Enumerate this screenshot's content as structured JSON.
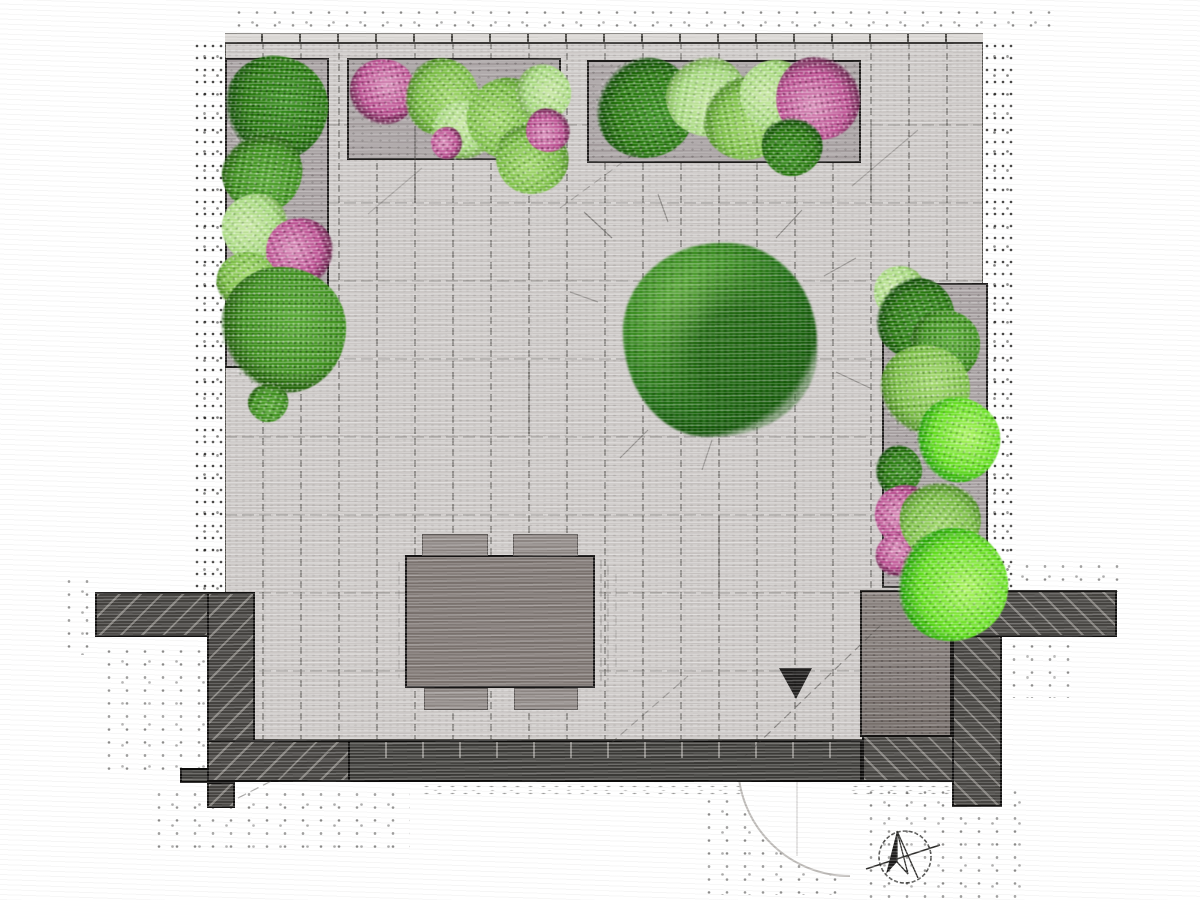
{
  "meta": {
    "type": "garden-landscape-plan",
    "canvas_w": 1200,
    "canvas_h": 900,
    "background": "#ffffff",
    "description": "Top-down sketch-style garden design plan: paved patio with tile grid, perimeter planting beds, central tree canopy, dining table with four chairs, hatched boundary walls, gate swing arc and north arrow"
  },
  "palette": {
    "paving": "#cbc7c5",
    "paving_joint": "#45433f",
    "bed_fill": "#a49d9e",
    "bed_border": "#1d1b1a",
    "wall_dark": "#44423f",
    "wall_solid": "#3b3a37",
    "wall_hatch_line": "#dedad4",
    "block_fill": "#7b7370",
    "table_fill": "#7a726e",
    "chair_fill": "#8c8582",
    "plant_dark_green": "#2a7612",
    "plant_medium_green": "#3f8d20",
    "plant_light_green": "#7cbc49",
    "plant_pale_green": "#a8d982",
    "plant_bright_green": "#67dd26",
    "flower_pink": "#b7508f",
    "outline": "#100f0e",
    "arc_line": "#b5b1ae",
    "symbol_ink": "#2c2b29"
  },
  "paving": {
    "x": 225,
    "y": 42,
    "w": 758,
    "h": 698,
    "tile_w": 38,
    "tile_h": 78,
    "first_row_h": 83
  },
  "edge_band": {
    "x": 225,
    "y": 33,
    "w": 758,
    "h": 11
  },
  "beds": [
    {
      "id": "planting-bed-left",
      "x": 225,
      "y": 58,
      "w": 104,
      "h": 310
    },
    {
      "id": "planting-bed-top-west",
      "x": 347,
      "y": 58,
      "w": 214,
      "h": 102
    },
    {
      "id": "planting-bed-top-east",
      "x": 587,
      "y": 60,
      "w": 274,
      "h": 103
    },
    {
      "id": "planting-bed-right",
      "x": 882,
      "y": 283,
      "w": 106,
      "h": 305
    }
  ],
  "tree": {
    "cx": 720,
    "cy": 340,
    "r": 97
  },
  "plants": [
    {
      "cx": 276,
      "cy": 108,
      "r": 52,
      "type": "dark"
    },
    {
      "cx": 262,
      "cy": 172,
      "r": 40,
      "type": "medium"
    },
    {
      "cx": 256,
      "cy": 228,
      "r": 34,
      "type": "pale"
    },
    {
      "cx": 300,
      "cy": 252,
      "r": 34,
      "type": "pink"
    },
    {
      "cx": 247,
      "cy": 282,
      "r": 30,
      "type": "light"
    },
    {
      "cx": 283,
      "cy": 330,
      "r": 63,
      "type": "medium"
    },
    {
      "cx": 268,
      "cy": 402,
      "r": 20,
      "type": "medium"
    },
    {
      "cx": 383,
      "cy": 92,
      "r": 33,
      "type": "pink"
    },
    {
      "cx": 441,
      "cy": 97,
      "r": 38,
      "type": "light"
    },
    {
      "cx": 463,
      "cy": 131,
      "r": 30,
      "type": "pale"
    },
    {
      "cx": 507,
      "cy": 118,
      "r": 40,
      "type": "light"
    },
    {
      "cx": 532,
      "cy": 158,
      "r": 36,
      "type": "light"
    },
    {
      "cx": 447,
      "cy": 143,
      "r": 16,
      "type": "pink"
    },
    {
      "cx": 543,
      "cy": 93,
      "r": 28,
      "type": "pale"
    },
    {
      "cx": 548,
      "cy": 130,
      "r": 22,
      "type": "pink"
    },
    {
      "cx": 645,
      "cy": 108,
      "r": 50,
      "type": "dark"
    },
    {
      "cx": 706,
      "cy": 96,
      "r": 40,
      "type": "pale"
    },
    {
      "cx": 745,
      "cy": 118,
      "r": 42,
      "type": "light"
    },
    {
      "cx": 775,
      "cy": 95,
      "r": 35,
      "type": "pale"
    },
    {
      "cx": 818,
      "cy": 98,
      "r": 42,
      "type": "pink"
    },
    {
      "cx": 792,
      "cy": 146,
      "r": 30,
      "type": "dark"
    },
    {
      "cx": 900,
      "cy": 292,
      "r": 26,
      "type": "pale"
    },
    {
      "cx": 915,
      "cy": 318,
      "r": 40,
      "type": "dark"
    },
    {
      "cx": 945,
      "cy": 345,
      "r": 35,
      "type": "medium"
    },
    {
      "cx": 925,
      "cy": 390,
      "r": 45,
      "type": "light"
    },
    {
      "cx": 958,
      "cy": 440,
      "r": 42,
      "type": "bright"
    },
    {
      "cx": 898,
      "cy": 470,
      "r": 24,
      "type": "dark"
    },
    {
      "cx": 905,
      "cy": 515,
      "r": 30,
      "type": "pink"
    },
    {
      "cx": 898,
      "cy": 555,
      "r": 22,
      "type": "pink"
    },
    {
      "cx": 940,
      "cy": 520,
      "r": 40,
      "type": "light"
    },
    {
      "cx": 952,
      "cy": 585,
      "r": 56,
      "type": "bright"
    }
  ],
  "walls": [
    {
      "id": "wall-west-arm",
      "x": 95,
      "y": 592,
      "w": 160,
      "h": 45,
      "style": "hatch-l"
    },
    {
      "id": "wall-west-vertical",
      "x": 207,
      "y": 592,
      "w": 48,
      "h": 190,
      "style": "hatch-l"
    },
    {
      "id": "wall-west-foot",
      "x": 180,
      "y": 768,
      "w": 30,
      "h": 15,
      "style": "solid"
    },
    {
      "id": "wall-west-stub",
      "x": 207,
      "y": 782,
      "w": 28,
      "h": 26,
      "style": "hatch-l"
    },
    {
      "id": "wall-south-west",
      "x": 207,
      "y": 740,
      "w": 143,
      "h": 42,
      "style": "hatch-l"
    },
    {
      "id": "wall-south",
      "x": 348,
      "y": 740,
      "w": 514,
      "h": 42,
      "style": "solid",
      "ticks": true
    },
    {
      "id": "wall-south-east",
      "x": 862,
      "y": 735,
      "w": 113,
      "h": 47,
      "style": "hatch-r"
    },
    {
      "id": "wall-east-vertical",
      "x": 952,
      "y": 588,
      "w": 50,
      "h": 219,
      "style": "hatch-r"
    },
    {
      "id": "wall-east-arm",
      "x": 952,
      "y": 590,
      "w": 165,
      "h": 47,
      "style": "hatch-r"
    }
  ],
  "block": {
    "id": "storage-block",
    "x": 860,
    "y": 590,
    "w": 92,
    "h": 147
  },
  "furniture": {
    "table": {
      "x": 405,
      "y": 555,
      "w": 190,
      "h": 133
    },
    "chairs": [
      {
        "x": 422,
        "y": 534,
        "w": 66,
        "h": 22
      },
      {
        "x": 513,
        "y": 534,
        "w": 65,
        "h": 22
      },
      {
        "x": 424,
        "y": 688,
        "w": 64,
        "h": 22
      },
      {
        "x": 514,
        "y": 688,
        "w": 64,
        "h": 22
      }
    ]
  },
  "door": {
    "hinge_x": 850,
    "hinge_y": 764,
    "radius": 112,
    "leaf": [
      797,
      780,
      797,
      856
    ]
  },
  "compass": {
    "cx": 905,
    "cy": 857,
    "r": 26,
    "cross_line": [
      866,
      869,
      940,
      845
    ],
    "tail_line": [
      897,
      831,
      918,
      878
    ],
    "needle_fill": "897,831 886,874 897,862",
    "needle_open": "897,831 908,874 897,862"
  },
  "triangle_marker": {
    "points": "779,668 812,668 796,699"
  },
  "sketch_lines": [
    [
      612,
      238,
      584,
      212,
      0.5
    ],
    [
      668,
      222,
      658,
      194,
      0.45
    ],
    [
      776,
      238,
      802,
      210,
      0.45
    ],
    [
      824,
      276,
      856,
      258,
      0.4
    ],
    [
      836,
      372,
      870,
      388,
      0.4
    ],
    [
      648,
      430,
      620,
      458,
      0.4
    ],
    [
      712,
      440,
      702,
      470,
      0.35
    ],
    [
      598,
      302,
      570,
      292,
      0.35
    ],
    [
      744,
      757,
      880,
      626,
      0.5
    ],
    [
      610,
      744,
      688,
      676,
      0.35
    ],
    [
      238,
      798,
      344,
      744,
      0.45
    ],
    [
      560,
      208,
      642,
      148,
      0.3
    ],
    [
      852,
      186,
      918,
      130,
      0.3
    ],
    [
      368,
      214,
      422,
      168,
      0.25
    ],
    [
      601,
      560,
      601,
      686,
      0.3
    ],
    [
      608,
      566,
      608,
      680,
      0.25
    ],
    [
      616,
      574,
      616,
      674,
      0.2
    ],
    [
      399,
      562,
      399,
      678,
      0.22
    ],
    [
      415,
      126,
      415,
      203,
      0.65
    ],
    [
      719,
      515,
      719,
      592,
      0.5
    ],
    [
      529,
      360,
      529,
      436,
      0.5
    ],
    [
      871,
      126,
      871,
      203,
      0.5
    ]
  ],
  "speckle_zones": [
    {
      "x": 193,
      "y": 40,
      "w": 32,
      "h": 552,
      "variant": "a"
    },
    {
      "x": 983,
      "y": 40,
      "w": 30,
      "h": 550,
      "variant": "a"
    },
    {
      "x": 230,
      "y": 6,
      "w": 830,
      "h": 26,
      "variant": "s"
    },
    {
      "x": 60,
      "y": 575,
      "w": 38,
      "h": 80,
      "variant": "s"
    },
    {
      "x": 100,
      "y": 645,
      "w": 105,
      "h": 128,
      "variant": "s"
    },
    {
      "x": 150,
      "y": 788,
      "w": 260,
      "h": 66,
      "variant": "s"
    },
    {
      "x": 420,
      "y": 783,
      "w": 560,
      "h": 14,
      "variant": "d"
    },
    {
      "x": 700,
      "y": 795,
      "w": 145,
      "h": 100,
      "variant": "s"
    },
    {
      "x": 862,
      "y": 786,
      "w": 160,
      "h": 112,
      "variant": "s"
    },
    {
      "x": 1000,
      "y": 560,
      "w": 120,
      "h": 32,
      "variant": "s"
    },
    {
      "x": 1005,
      "y": 640,
      "w": 70,
      "h": 58,
      "variant": "s"
    }
  ]
}
